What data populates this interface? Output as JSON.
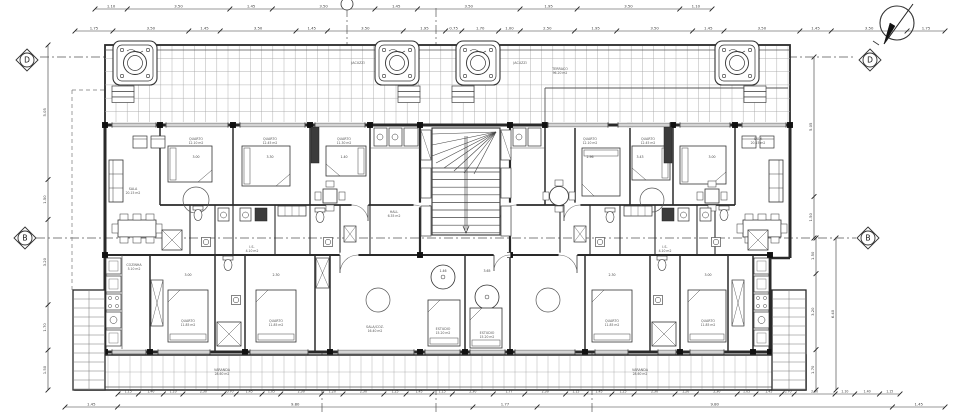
{
  "grid_markers": {
    "d_left": "D",
    "d_right": "D",
    "b_left": "B",
    "b_right": "B",
    "top_center": ""
  },
  "dimensions": {
    "top_row_1": [
      "1.10",
      "3.50",
      "1.45",
      "3.50",
      "1.45",
      "3.50",
      "1.95",
      "3.50",
      "1.10"
    ],
    "top_row_2": [
      "1.75",
      "3.50",
      "1.45",
      "3.50",
      "1.45",
      "3.50",
      "1.95",
      "0.75",
      "1.70",
      "1.00",
      "2.50",
      "1.95",
      "3.50",
      "1.45",
      "3.50",
      "1.45",
      "3.50",
      "1.75"
    ],
    "bottom_row_1": [
      "1.15",
      "1.40",
      "1.10",
      "2.30",
      "0.70",
      "1.45",
      "1.05",
      "2.30",
      "1.20",
      "2.30",
      "1.25",
      "1.45",
      "1.15",
      "2.30",
      "1.77",
      "2.30",
      "1.15",
      "1.45",
      "1.25",
      "2.30",
      "1.20",
      "2.30",
      "1.05",
      "1.45",
      "0.70",
      "2.30",
      "1.10",
      "1.40",
      "1.15"
    ],
    "bottom_row_2": [
      "1.45",
      "9.80",
      "1.77",
      "9.80",
      "1.45"
    ],
    "left_col": [
      "5.05",
      "1.50",
      "3.20",
      "1.70",
      "1.50"
    ],
    "right_col_upper": [
      "5.05",
      "1.50"
    ],
    "right_col_lower": [
      "1.50",
      "3.20",
      "1.70"
    ],
    "right_col_outer": [
      "6.40"
    ]
  },
  "interior_dims": {
    "row_upper": [
      "3.00",
      "3.30",
      "1.40",
      "2.96",
      "3.43",
      "3.00"
    ],
    "row_lower": [
      "3.00",
      "2.30",
      "1.46",
      "3.65",
      "2.30",
      "3.00"
    ]
  },
  "room_labels": [
    {
      "name": "SALA",
      "area": "20.15 m2"
    },
    {
      "name": "QUARTO",
      "area": "12.10 m2"
    },
    {
      "name": "QUARTO",
      "area": "12.45 m2"
    },
    {
      "name": "QUARTO",
      "area": "11.30 m2"
    },
    {
      "name": "I.S.",
      "area": "4.10 m2"
    },
    {
      "name": "HALL",
      "area": "6.35 m2"
    },
    {
      "name": "QUARTO",
      "area": "12.10 m2"
    },
    {
      "name": "QUARTO",
      "area": "12.45 m2"
    },
    {
      "name": "SALA",
      "area": "20.15 m2"
    },
    {
      "name": "I.S.",
      "area": "4.10 m2"
    },
    {
      "name": "QUARTO",
      "area": "11.85 m2"
    },
    {
      "name": "QUARTO",
      "area": "11.85 m2"
    },
    {
      "name": "SALA/COZ.",
      "area": "16.40 m2"
    },
    {
      "name": "ESTUDIO",
      "area": "15.20 m2"
    },
    {
      "name": "ESTUDIO",
      "area": "15.20 m2"
    },
    {
      "name": "QUARTO",
      "area": "11.85 m2"
    },
    {
      "name": "QUARTO",
      "area": "11.85 m2"
    },
    {
      "name": "VARANDA",
      "area": "28.60 m2"
    },
    {
      "name": "VARANDA",
      "area": "28.60 m2"
    },
    {
      "name": "TERRACO",
      "area": "96.20 m2"
    },
    {
      "name": "JACUZZI",
      "area": ""
    },
    {
      "name": "JACUZZI",
      "area": ""
    },
    {
      "name": "COZINHA",
      "area": "5.10 m2"
    }
  ],
  "colors": {
    "wall": "#2a2a2a",
    "line": "#444444",
    "grid": "#a8a8a8",
    "dash": "#555555",
    "text": "#3a3a3a"
  }
}
